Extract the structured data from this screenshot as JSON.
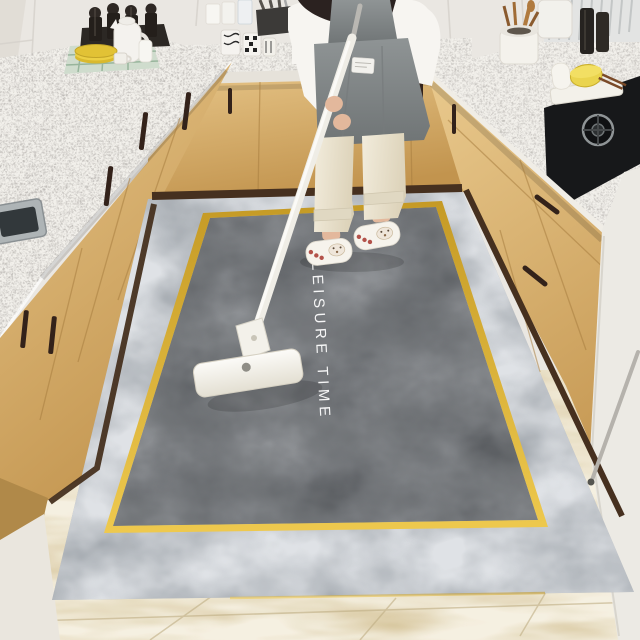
{
  "rug": {
    "text": "LEISURE TIME",
    "outer_border_color": "#9aa0a6",
    "field_color": "#55585c",
    "gold_line_color": "#d8a62e"
  },
  "scene_objects": {
    "left_counter": "kitchen sink counter",
    "right_counter": "gas stove counter",
    "person": "person mopping rug",
    "mop": "white flat mop"
  },
  "css_vars": {
    "--wall": "#eae7e2",
    "--wall-seam": "#d5d1cb",
    "--counter": "#f2f0eb",
    "--counter-edge": "#e9e5dd",
    "--cabinet-light": "#e5c386",
    "--cabinet-dark": "#c2944e",
    "--cabinet-seam": "#a87e40",
    "--handle": "#33221a",
    "--baseboard": "#46301f",
    "--floor": "#d9c9a2",
    "--rug-outer": "#9aa0a6",
    "--rug-inner": "#55585c",
    "--gold-1": "#c59a25",
    "--gold-2": "#eec94e",
    "--shirt": "#f7f5f1",
    "--apron": "#878c8d",
    "--apron-dark": "#6f7475",
    "--pants": "#ece5d3",
    "--skin": "#e3b89c",
    "--hair": "#2b2220",
    "--mop": "#f4f2ed",
    "--stove": "#17181a",
    "--rug-text": "rgba(255,255,255,0.93)"
  }
}
